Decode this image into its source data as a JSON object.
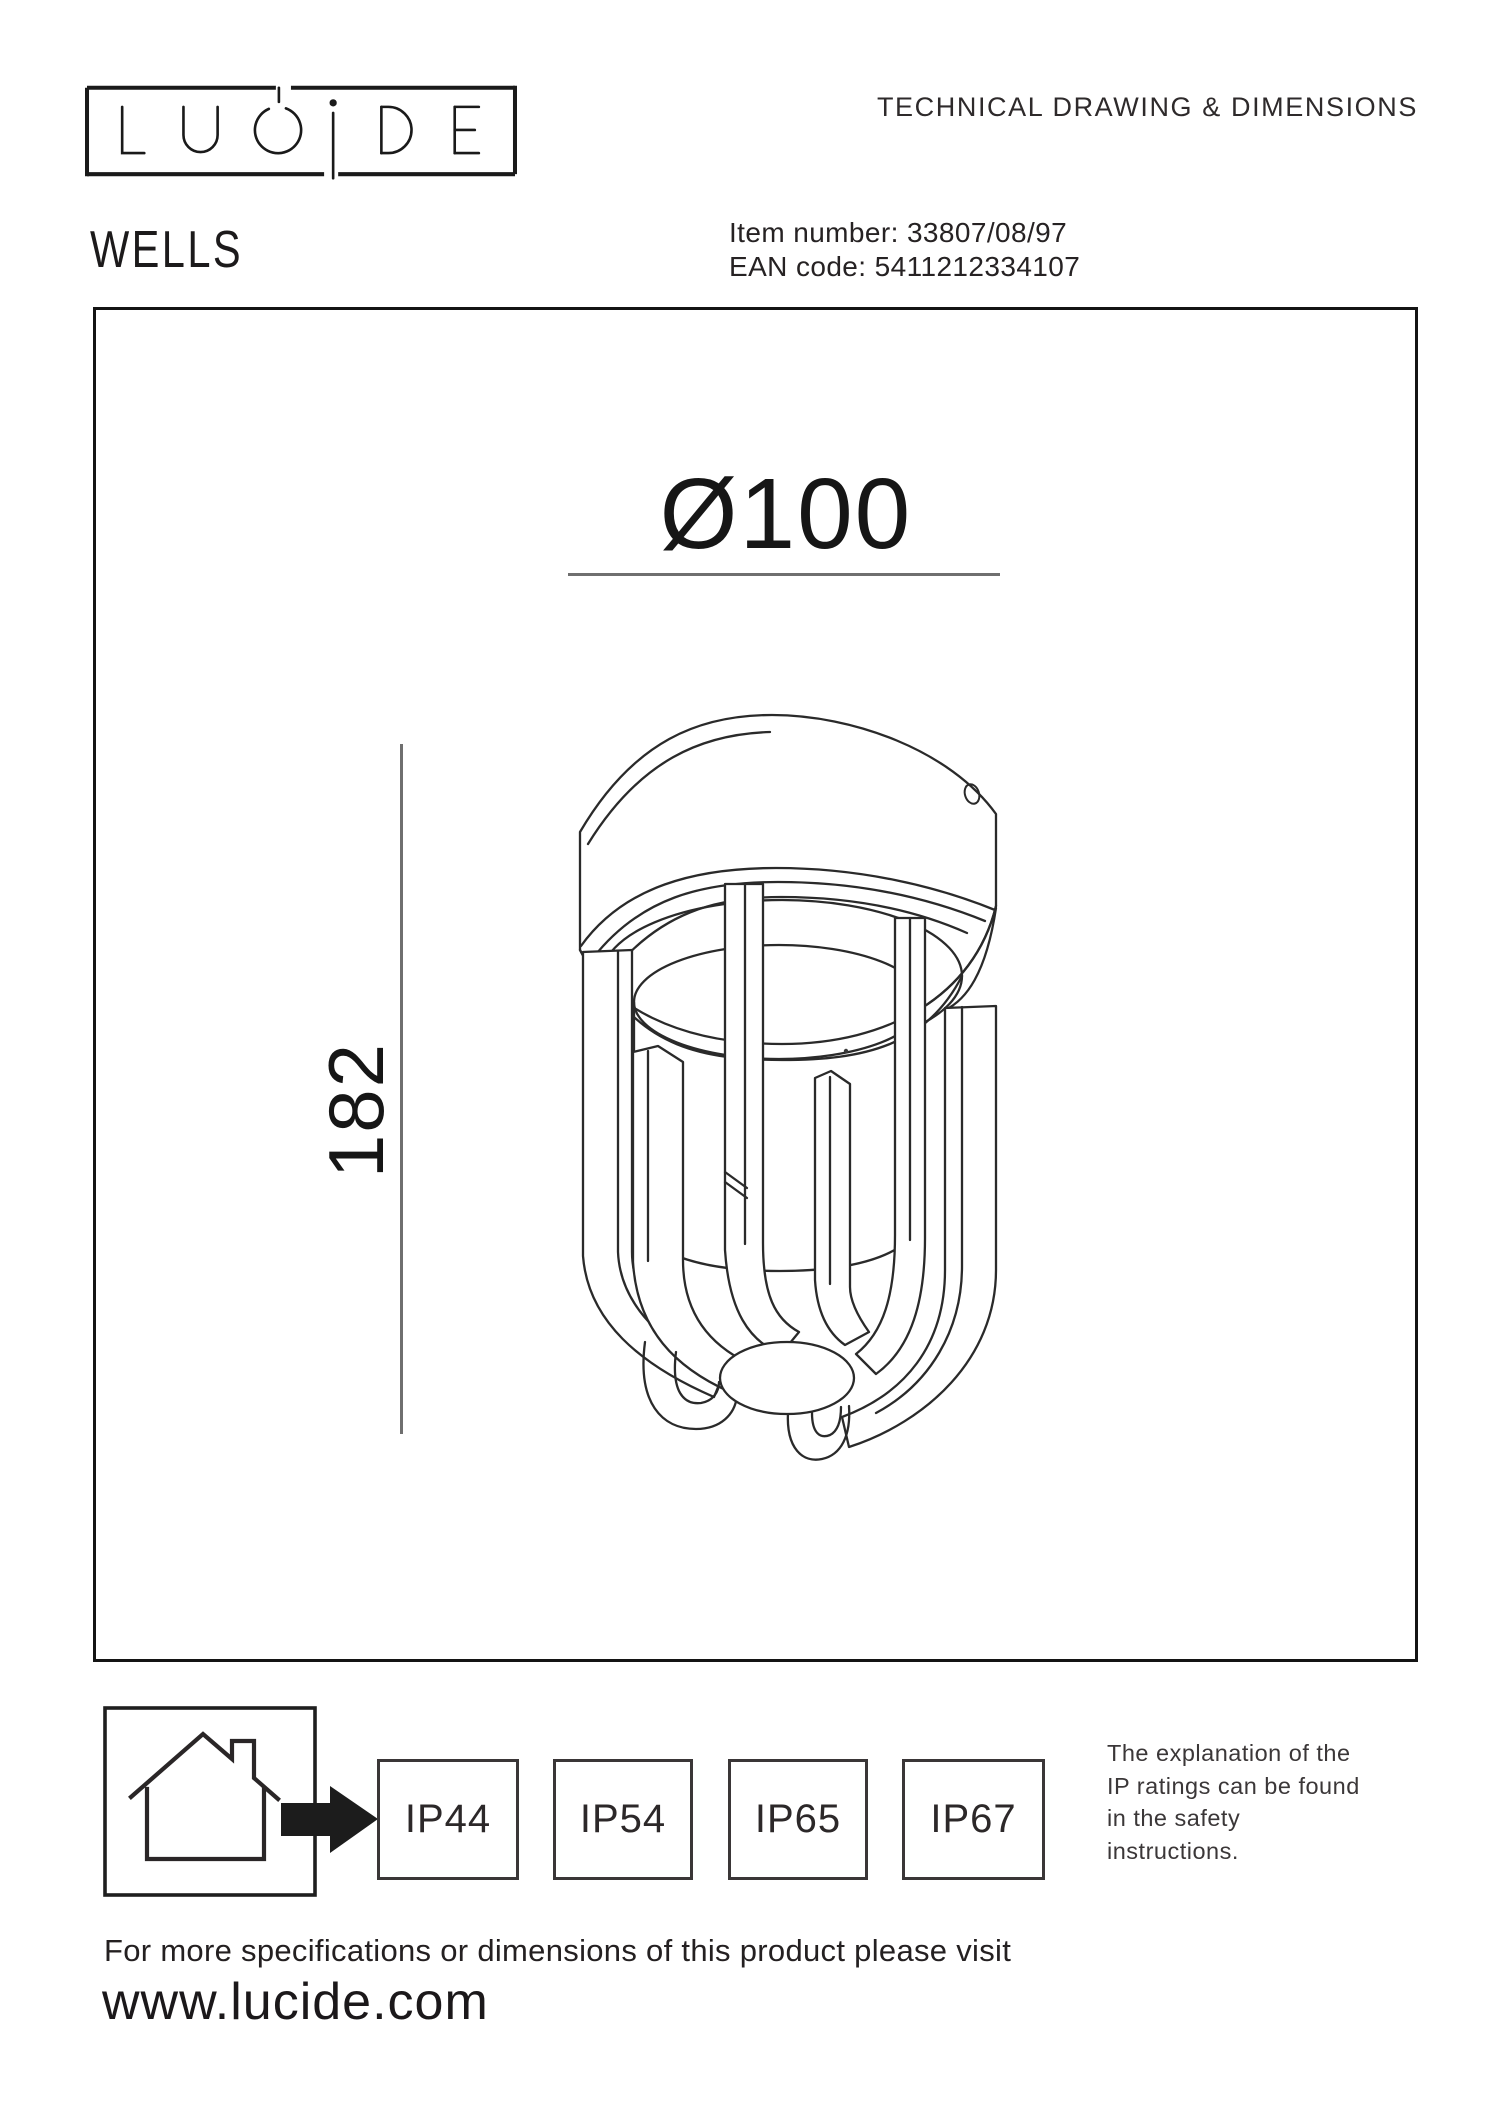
{
  "header": {
    "doc_title": "TECHNICAL DRAWING & DIMENSIONS",
    "logo_text": "LUCIDE",
    "product_name": "WELLS",
    "item_label": "Item number:",
    "item_value": "33807/08/97",
    "ean_label": "EAN code:",
    "ean_value": "5411212334107"
  },
  "drawing": {
    "diameter_dim": "Ø100",
    "height_dim": "182"
  },
  "ip_section": {
    "ratings": [
      "IP44",
      "IP54",
      "IP65",
      "IP67"
    ],
    "note_lines": [
      "The explanation of the",
      "IP ratings can be found",
      "in the safety",
      "instructions."
    ]
  },
  "icons": {
    "house": "house-indoor-outdoor-icon",
    "arrow": "arrow-right-icon"
  },
  "colors": {
    "ink": "#231f20",
    "line": "#2a2a2a",
    "dim_line": "#6f6f6f",
    "background": "#ffffff"
  },
  "footer": {
    "note": "For more specifications or dimensions of this product please visit",
    "url": "www.lucide.com"
  }
}
